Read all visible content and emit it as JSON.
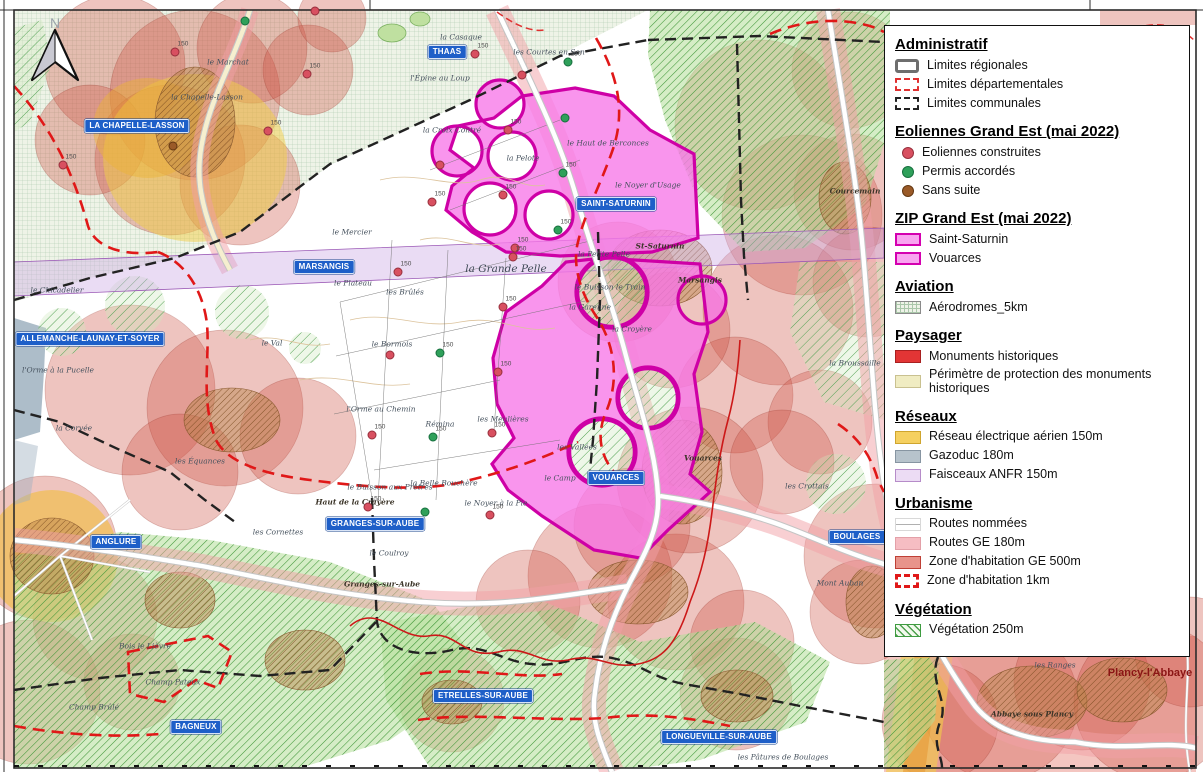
{
  "legend": {
    "sections": [
      {
        "title": "Administratif",
        "items": [
          {
            "label": "Limites régionales"
          },
          {
            "label": "Limites départementales"
          },
          {
            "label": "Limites communales"
          }
        ]
      },
      {
        "title": "Eoliennes Grand Est (mai 2022)",
        "items": [
          {
            "label": "Eoliennes construites"
          },
          {
            "label": "Permis accordés"
          },
          {
            "label": "Sans suite"
          }
        ]
      },
      {
        "title": "ZIP Grand Est (mai 2022)",
        "items": [
          {
            "label": "Saint-Saturnin"
          },
          {
            "label": "Vouarces"
          }
        ]
      },
      {
        "title": "Aviation",
        "items": [
          {
            "label": "Aérodromes_5km"
          }
        ]
      },
      {
        "title": "Paysager",
        "items": [
          {
            "label": "Monuments historiques"
          },
          {
            "label": "Périmètre de protection des monuments historiques"
          }
        ]
      },
      {
        "title": "Réseaux",
        "items": [
          {
            "label": "Réseau électrique aérien 150m"
          },
          {
            "label": "Gazoduc 180m"
          },
          {
            "label": "Faisceaux ANFR 150m"
          }
        ]
      },
      {
        "title": "Urbanisme",
        "items": [
          {
            "label": "Routes nommées"
          },
          {
            "label": "Routes GE 180m"
          },
          {
            "label": "Zone d'habitation GE 500m"
          },
          {
            "label": "Zone d'habitation 1km"
          }
        ]
      },
      {
        "title": "Végétation",
        "items": [
          {
            "label": "Végétation 250m"
          }
        ]
      }
    ]
  },
  "map": {
    "north_label": "N",
    "colors": {
      "town_label_bg": "#1e5fc8",
      "zip_stroke": "#ce00a6",
      "zip_fill": "#f87ae9",
      "habitation_500m": "#ce5242",
      "habitation_1km_dash": "#e01818",
      "routes_ge": "#f2a0a5",
      "reseau_electrique": "#f2cd46",
      "gazoduc": "#9fb2c0",
      "anfr": "#cdacE4",
      "vegetation": "#4da04d",
      "eolienne_construite": "#d85060",
      "permis_accorde": "#2fa05a",
      "sans_suite": "#9a5a28"
    },
    "towns": [
      {
        "name": "THAAS",
        "x": 447,
        "y": 52
      },
      {
        "name": "LA CHAPELLE-LASSON",
        "x": 137,
        "y": 126
      },
      {
        "name": "SAINT-SATURNIN",
        "x": 616,
        "y": 204
      },
      {
        "name": "MARSANGIS",
        "x": 324,
        "y": 267
      },
      {
        "name": "ALLEMANCHE-LAUNAY-ET-SOYER",
        "x": 90,
        "y": 339
      },
      {
        "name": "ANGLURE",
        "x": 116,
        "y": 542
      },
      {
        "name": "GRANGES-SUR-AUBE",
        "x": 375,
        "y": 524
      },
      {
        "name": "VOUARCES",
        "x": 616,
        "y": 478
      },
      {
        "name": "BOULAGES",
        "x": 857,
        "y": 537
      },
      {
        "name": "BAGNEUX",
        "x": 196,
        "y": 727
      },
      {
        "name": "ETRELLES-SUR-AUBE",
        "x": 483,
        "y": 696
      },
      {
        "name": "LONGUEVILLE-SUR-AUBE",
        "x": 719,
        "y": 737
      }
    ],
    "places": [
      {
        "name": "le Marchat",
        "x": 228,
        "y": 62
      },
      {
        "name": "la Chapelle-Lasson",
        "x": 207,
        "y": 97
      },
      {
        "name": "la Casaque",
        "x": 461,
        "y": 37
      },
      {
        "name": "les Courtes en Son",
        "x": 549,
        "y": 52
      },
      {
        "name": "l'Épine au Loup",
        "x": 440,
        "y": 78
      },
      {
        "name": "la Croix Contré",
        "x": 452,
        "y": 130
      },
      {
        "name": "le Haut de Berconces",
        "x": 608,
        "y": 143
      },
      {
        "name": "la Pelote",
        "x": 523,
        "y": 158
      },
      {
        "name": "le Noyer d'Usage",
        "x": 648,
        "y": 185
      },
      {
        "name": "le Mercier",
        "x": 352,
        "y": 232
      },
      {
        "name": "St-Saturnin",
        "x": 660,
        "y": 246,
        "cls": "bold"
      },
      {
        "name": "Marsangis",
        "x": 700,
        "y": 280,
        "cls": "bold"
      },
      {
        "name": "la Petite Pelle",
        "x": 604,
        "y": 254
      },
      {
        "name": "la Grande Pelle",
        "x": 506,
        "y": 269,
        "cls": "lg"
      },
      {
        "name": "le Buisson le Train",
        "x": 610,
        "y": 287
      },
      {
        "name": "la Garenne",
        "x": 590,
        "y": 307
      },
      {
        "name": "la Croyère",
        "x": 632,
        "y": 329
      },
      {
        "name": "le Chicadelier",
        "x": 57,
        "y": 290
      },
      {
        "name": "le Plateau",
        "x": 353,
        "y": 283
      },
      {
        "name": "les Brûlés",
        "x": 405,
        "y": 292
      },
      {
        "name": "le Val",
        "x": 272,
        "y": 343
      },
      {
        "name": "le Bormois",
        "x": 392,
        "y": 344
      },
      {
        "name": "l'Orme au Chemin",
        "x": 381,
        "y": 409
      },
      {
        "name": "Rémina",
        "x": 440,
        "y": 424
      },
      {
        "name": "les Meulières",
        "x": 503,
        "y": 419
      },
      {
        "name": "les Équances",
        "x": 200,
        "y": 461
      },
      {
        "name": "l'Orme à la Pucelle",
        "x": 58,
        "y": 370
      },
      {
        "name": "la Corvée",
        "x": 74,
        "y": 428
      },
      {
        "name": "les Vallées",
        "x": 577,
        "y": 447
      },
      {
        "name": "le Camp",
        "x": 560,
        "y": 478
      },
      {
        "name": "la Broussaille",
        "x": 855,
        "y": 363
      },
      {
        "name": "Courcemain",
        "x": 855,
        "y": 191,
        "cls": "bold"
      },
      {
        "name": "Haut de la Crayère",
        "x": 355,
        "y": 502,
        "cls": "bold"
      },
      {
        "name": "le Buisson aux Prêtres",
        "x": 390,
        "y": 487
      },
      {
        "name": "la Belle Bouchère",
        "x": 444,
        "y": 483
      },
      {
        "name": "le Noyer à la Pie",
        "x": 496,
        "y": 503
      },
      {
        "name": "les Cornettes",
        "x": 278,
        "y": 532
      },
      {
        "name": "le Coulroy",
        "x": 389,
        "y": 553
      },
      {
        "name": "Granges-sur-Aube",
        "x": 382,
        "y": 584,
        "cls": "bold"
      },
      {
        "name": "Vouarces",
        "x": 703,
        "y": 458,
        "cls": "bold"
      },
      {
        "name": "les Crottais",
        "x": 807,
        "y": 486
      },
      {
        "name": "Mont Auban",
        "x": 840,
        "y": 583
      },
      {
        "name": "Bois le Lièvre",
        "x": 145,
        "y": 646
      },
      {
        "name": "Champ Pateux",
        "x": 173,
        "y": 682
      },
      {
        "name": "Champ Brûlé",
        "x": 94,
        "y": 707
      },
      {
        "name": "les Ranges",
        "x": 1055,
        "y": 665
      },
      {
        "name": "Abbaye sous Plancy",
        "x": 1032,
        "y": 714,
        "cls": "bold"
      },
      {
        "name": "Plancy-l'Abbaye",
        "x": 1150,
        "y": 673,
        "cls": "city"
      },
      {
        "name": "les Pâtures de Boulages",
        "x": 783,
        "y": 757
      }
    ],
    "markers": [
      {
        "type": "construite",
        "x": 175,
        "y": 52,
        "label": "150"
      },
      {
        "type": "construite",
        "x": 307,
        "y": 74,
        "label": "150"
      },
      {
        "type": "construite",
        "x": 268,
        "y": 131,
        "label": "150"
      },
      {
        "type": "construite",
        "x": 63,
        "y": 165,
        "label": "150"
      },
      {
        "type": "construite",
        "x": 315,
        "y": 11
      },
      {
        "type": "construite",
        "x": 475,
        "y": 54,
        "label": "150"
      },
      {
        "type": "construite",
        "x": 522,
        "y": 75
      },
      {
        "type": "construite",
        "x": 508,
        "y": 130,
        "label": "150"
      },
      {
        "type": "construite",
        "x": 440,
        "y": 165
      },
      {
        "type": "construite",
        "x": 432,
        "y": 202,
        "label": "150"
      },
      {
        "type": "construite",
        "x": 503,
        "y": 195,
        "label": "150"
      },
      {
        "type": "construite",
        "x": 515,
        "y": 248,
        "label": "150"
      },
      {
        "type": "construite",
        "x": 398,
        "y": 272,
        "label": "150"
      },
      {
        "type": "construite",
        "x": 513,
        "y": 257,
        "label": "150"
      },
      {
        "type": "construite",
        "x": 503,
        "y": 307,
        "label": "150"
      },
      {
        "type": "construite",
        "x": 498,
        "y": 372,
        "label": "150"
      },
      {
        "type": "construite",
        "x": 390,
        "y": 355
      },
      {
        "type": "construite",
        "x": 372,
        "y": 435,
        "label": "150"
      },
      {
        "type": "construite",
        "x": 492,
        "y": 433,
        "label": "150"
      },
      {
        "type": "construite",
        "x": 368,
        "y": 507,
        "label": "150"
      },
      {
        "type": "construite",
        "x": 490,
        "y": 515,
        "label": "150"
      },
      {
        "type": "permis",
        "x": 245,
        "y": 21
      },
      {
        "type": "permis",
        "x": 568,
        "y": 62,
        "label": "150"
      },
      {
        "type": "permis",
        "x": 565,
        "y": 118
      },
      {
        "type": "permis",
        "x": 563,
        "y": 173,
        "label": "150"
      },
      {
        "type": "permis",
        "x": 558,
        "y": 230,
        "label": "150"
      },
      {
        "type": "permis",
        "x": 440,
        "y": 353,
        "label": "150"
      },
      {
        "type": "permis",
        "x": 433,
        "y": 437,
        "label": "150"
      },
      {
        "type": "permis",
        "x": 425,
        "y": 512
      },
      {
        "type": "sans-suite",
        "x": 173,
        "y": 146
      }
    ]
  }
}
